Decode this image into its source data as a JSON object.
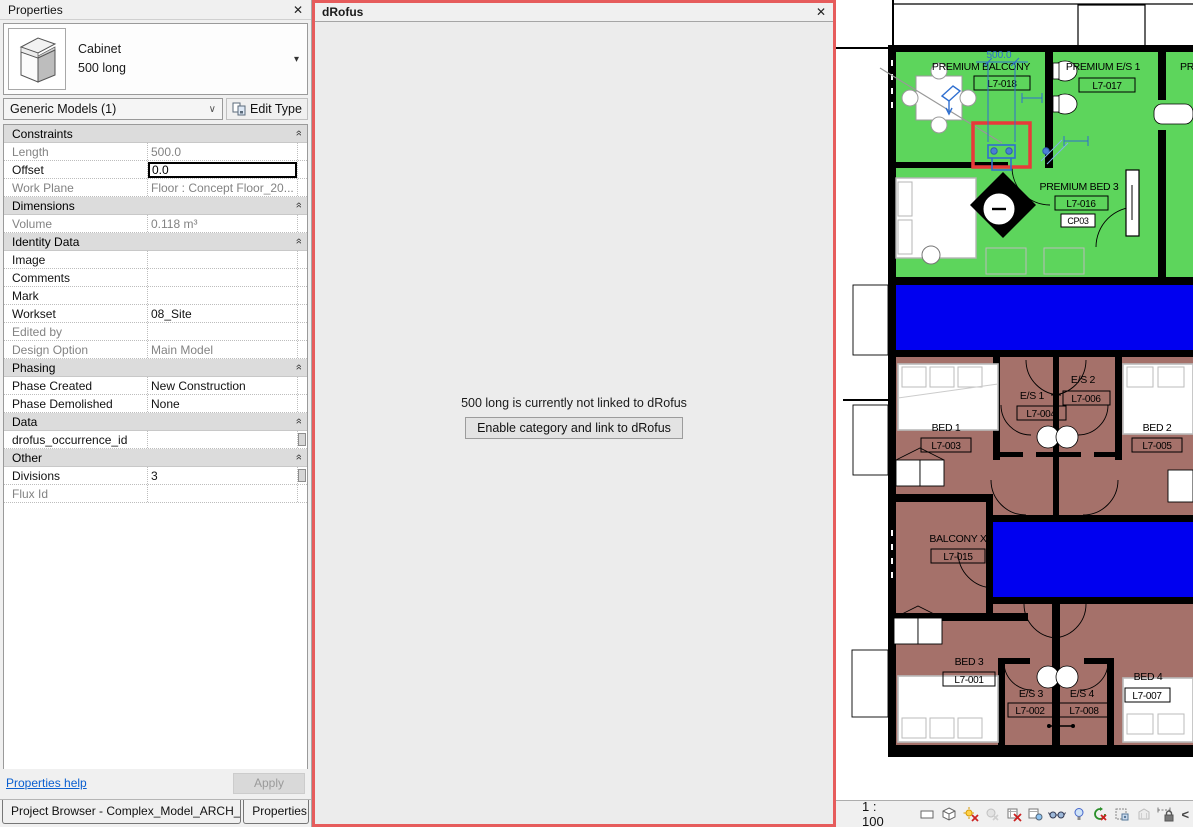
{
  "properties_panel": {
    "title": "Properties",
    "type_selector": {
      "family": "Cabinet",
      "type_name": "500 long"
    },
    "category_select": {
      "value": "Generic Models (1)"
    },
    "edit_type_button": "Edit Type",
    "rows": [
      {
        "kind": "section",
        "label": "Constraints"
      },
      {
        "kind": "row",
        "label": "Length",
        "value": "500.0",
        "readonly": true
      },
      {
        "kind": "row",
        "label": "Offset",
        "value": "0.0",
        "editing": true
      },
      {
        "kind": "row",
        "label": "Work Plane",
        "value": "Floor : Concept Floor_20...",
        "readonly": true
      },
      {
        "kind": "section",
        "label": "Dimensions"
      },
      {
        "kind": "row",
        "label": "Volume",
        "value": "0.118 m³",
        "readonly": true
      },
      {
        "kind": "section",
        "label": "Identity Data"
      },
      {
        "kind": "row",
        "label": "Image",
        "value": ""
      },
      {
        "kind": "row",
        "label": "Comments",
        "value": ""
      },
      {
        "kind": "row",
        "label": "Mark",
        "value": ""
      },
      {
        "kind": "row",
        "label": "Workset",
        "value": "08_Site"
      },
      {
        "kind": "row",
        "label": "Edited by",
        "value": "",
        "readonly": true
      },
      {
        "kind": "row",
        "label": "Design Option",
        "value": "Main Model",
        "readonly": true
      },
      {
        "kind": "section",
        "label": "Phasing"
      },
      {
        "kind": "row",
        "label": "Phase Created",
        "value": "New Construction"
      },
      {
        "kind": "row",
        "label": "Phase Demolished",
        "value": "None"
      },
      {
        "kind": "section",
        "label": "Data"
      },
      {
        "kind": "row",
        "label": "drofus_occurrence_id",
        "value": "",
        "has_button": true
      },
      {
        "kind": "section",
        "label": "Other"
      },
      {
        "kind": "row",
        "label": "Divisions",
        "value": "3",
        "has_button": true
      },
      {
        "kind": "row",
        "label": "Flux Id",
        "value": "",
        "readonly": true
      }
    ],
    "help_link": "Properties help",
    "apply_button": "Apply",
    "tabs": [
      {
        "label": "Project Browser - Complex_Model_ARCH_Wi..."
      },
      {
        "label": "Properties"
      }
    ]
  },
  "drofus_panel": {
    "title": "dRofus",
    "message": "500 long is currently not linked to dRofus",
    "button": "Enable category and link to dRofus",
    "highlight_color": "#e65c5c"
  },
  "plan": {
    "rooms": [
      {
        "name": "PREMIUM BALCONY",
        "tag": "L7-018"
      },
      {
        "name": "PREMIUM E/S 1",
        "tag": "L7-017"
      },
      {
        "name": "PREMIUM BED 3",
        "tag": "L7-016"
      },
      {
        "name": "BED 1",
        "tag": "L7-003"
      },
      {
        "name": "E/S 1",
        "tag": "L7-004"
      },
      {
        "name": "E/S 2",
        "tag": "L7-006"
      },
      {
        "name": "BED 2",
        "tag": "L7-005"
      },
      {
        "name": "BALCONY X",
        "tag": "L7-015"
      },
      {
        "name": "BED 3",
        "tag": "L7-001"
      },
      {
        "name": "E/S 3",
        "tag": "L7-002"
      },
      {
        "name": "E/S 4",
        "tag": "L7-008"
      },
      {
        "name": "BED 4",
        "tag": "L7-007"
      }
    ],
    "clipped_label": "PR",
    "keynote": "CP03",
    "dimension": "500.0",
    "colors": {
      "premium_room": "#5dd55c",
      "bedroom": "#a5716a",
      "corridor": "#0000f0",
      "selection_blue": "#2f6fd0",
      "highlight_red": "#e83a3a"
    }
  },
  "view_control_bar": {
    "scale": "1 : 100",
    "icons": [
      "detail-level",
      "visual-style",
      "sun-path",
      "shadows",
      "crop-view",
      "show-crop-region",
      "temporary-hide-isolate",
      "reveal-hidden-elements",
      "temporary-view-properties",
      "show-analytical-model",
      "highlight-displaced-elements",
      "reveal-constraints"
    ],
    "collapse_glyph": "<"
  },
  "icons": {
    "close": "✕",
    "dropdown": "▾",
    "combo_chevron": "∨",
    "section_chevron": "»"
  }
}
